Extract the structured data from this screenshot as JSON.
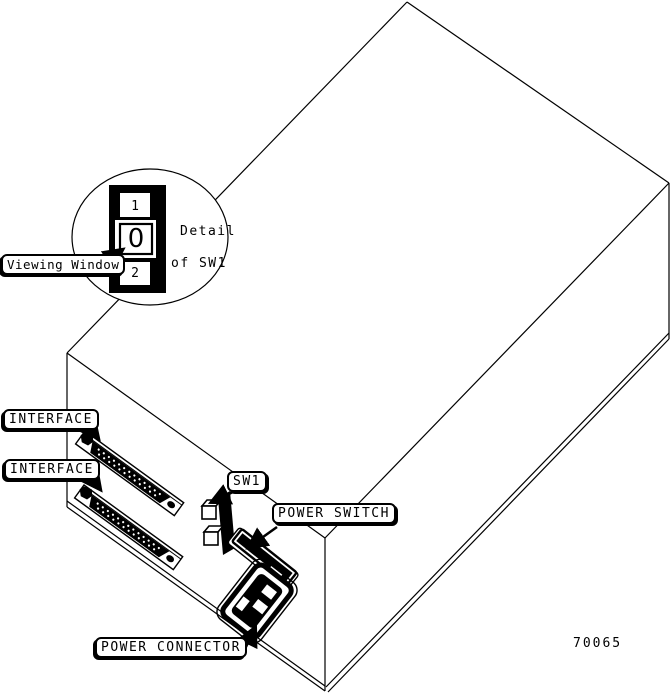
{
  "figure": {
    "part_number": "70065",
    "detail_caption_line1": "Detail",
    "detail_caption_line2": "of SW1",
    "switch_positions": [
      "1",
      "0",
      "2"
    ],
    "labels": {
      "viewing_window": "Viewing Window",
      "interface_1": "INTERFACE",
      "interface_2": "INTERFACE",
      "sw1": "SW1",
      "power_switch": "POWER SWITCH",
      "power_connector": "POWER CONNECTOR"
    },
    "colors": {
      "line": "#000000",
      "background": "#ffffff"
    }
  }
}
